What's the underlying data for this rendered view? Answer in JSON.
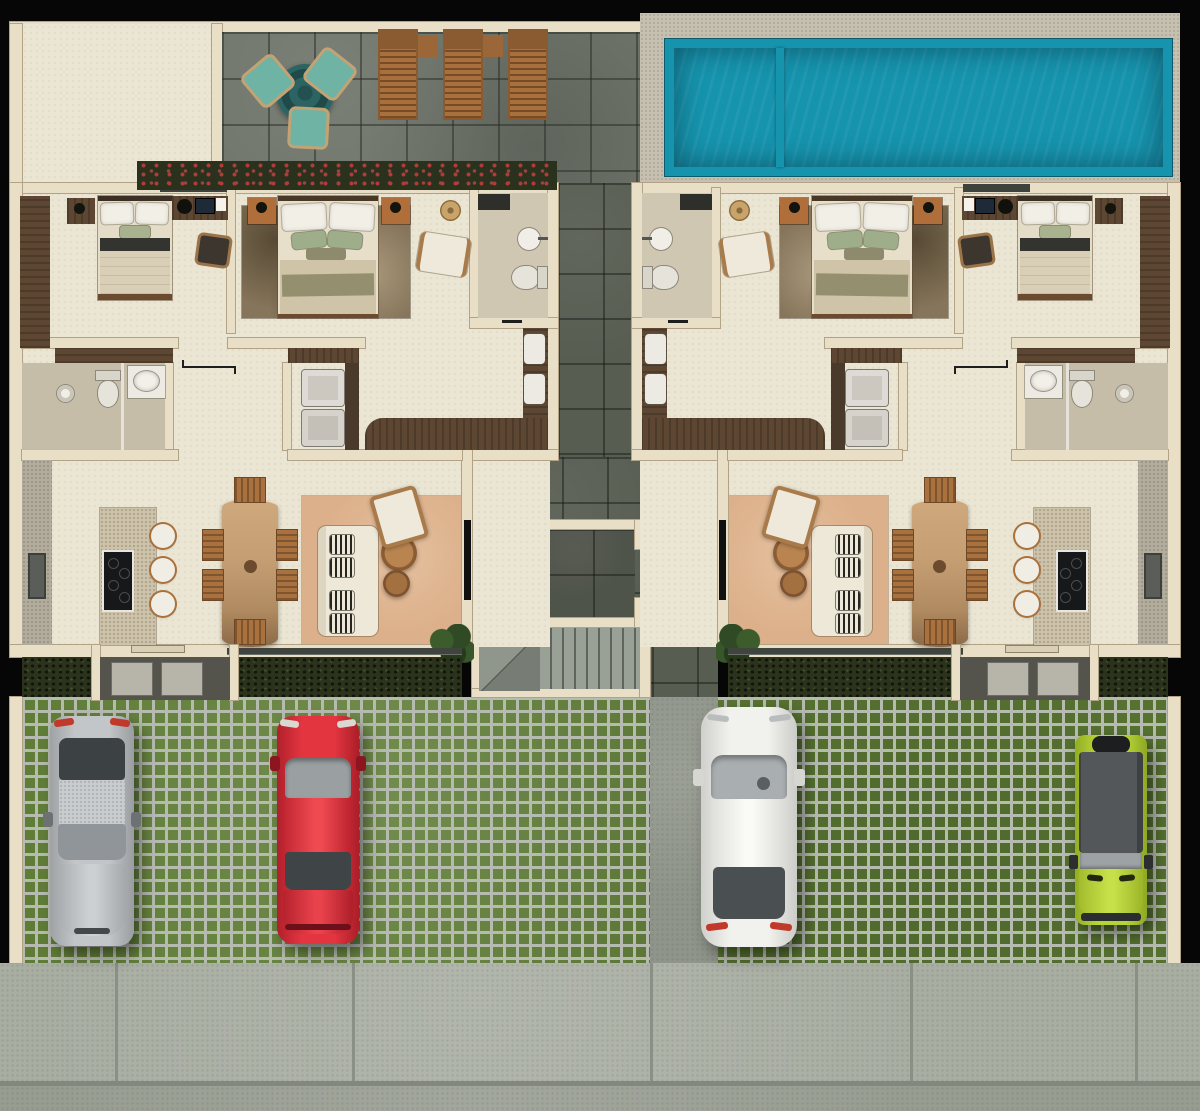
{
  "image_type": "top-down 3D rendered residential floor plan (no visible text)",
  "palette": {
    "wall": "#e9dfc6",
    "wallline": "#b2a387",
    "floor": "#ebe5d3",
    "tile": "#6f756b",
    "corridor": "#585d52",
    "deck": "#c7c0b0",
    "poolrim": "#1694ae",
    "poolwater": "#3a8797",
    "pooldeep": "#26united6d7d",
    "grass": "#5c7a33",
    "grassgrid": "#b6bbb0",
    "sidewalk": "#a9aea3",
    "road": "#989d92",
    "walkway": "#90958b",
    "hedge": "#2a321d",
    "flower": "#b23b3c",
    "hedgefront": "#2b331c",
    "porch": "#54544c",
    "mat": "#b7b4a9",
    "wooddark": "#5d4733",
    "rust": "#b06f3a",
    "diningwood": "#a8713d",
    "diningtable": "#c59e74",
    "rugliving": "#dcb08a",
    "rugbedroom": "#86755a",
    "sofa": "#eee8d8",
    "boucle": "#efe9dc",
    "island": "#cdc3ab",
    "graycounter": "#b3ac9c",
    "lounger": "#a8703c",
    "tealchair": "#6fb3a4",
    "tealtable": "#2c6463",
    "stairlight": "#b3b9af",
    "glassdark": "#3f443f",
    "tv": "#101010",
    "carsilver": "#c3c6c8",
    "carred": "#e23540",
    "carwhite": "#f1f1ee",
    "cargreen": "#b7d437",
    "carroof": "#53575a",
    "black": "#060606"
  },
  "building": {
    "units": 2,
    "mirrored": true,
    "rooms_per_unit": [
      "bedroom-1",
      "bedroom-2",
      "bathroom",
      "powder-bath",
      "laundry",
      "hall",
      "kitchen",
      "dining",
      "living"
    ],
    "inventory_per_unit": {
      "beds": 2,
      "nightstands": 3,
      "desks": 1,
      "desk_chairs": 1,
      "wardrobes": 1,
      "armchairs": 2,
      "sofas": 1,
      "coffee_tables": 2,
      "dining_chairs": 6,
      "bar_stools": 3,
      "cooktop_burners": 4,
      "toilets": 2,
      "basins": 4,
      "kitchen_sinks": 1,
      "showers": 1,
      "stacked_washer_dryer": 2,
      "tv": 1,
      "plants": 1,
      "baskets": 1,
      "door_mats": 2,
      "area_rugs": 2
    }
  },
  "amenities": {
    "pool": {
      "sections": 2,
      "rim_color": "#1694ae",
      "water_color": "#3a8797"
    },
    "terrace": {
      "loungers": 3,
      "side_tables": 2,
      "cafe_table": 1,
      "cafe_chairs": 3,
      "flower_hedge": true
    },
    "stair_core": {
      "stairs": true,
      "elevator_c_wall": true
    }
  },
  "parking": {
    "paving": "grass-grid pavers",
    "walkway": "concrete strip from stair core to sidewalk",
    "cars": [
      {
        "name": "silver-sedan",
        "hex": "#c3c6c8",
        "facing": "down"
      },
      {
        "name": "red-sedan",
        "hex": "#e23540",
        "facing": "up"
      },
      {
        "name": "white-sedan",
        "hex": "#f1f1ee",
        "facing": "up"
      },
      {
        "name": "lime-suv",
        "hex": "#b7d437",
        "facing": "down"
      }
    ]
  }
}
